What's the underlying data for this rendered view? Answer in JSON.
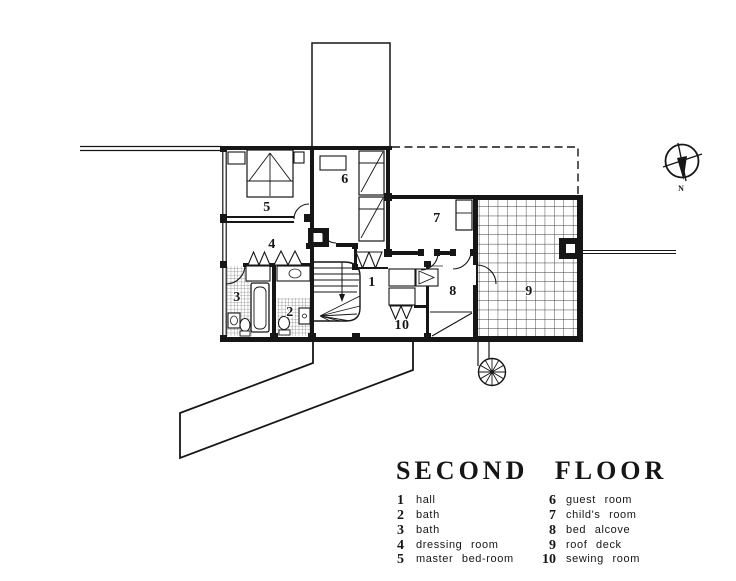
{
  "title": "SECOND FLOOR",
  "rooms": [
    {
      "num": "1",
      "label": "hall"
    },
    {
      "num": "2",
      "label": "bath"
    },
    {
      "num": "3",
      "label": "bath"
    },
    {
      "num": "4",
      "label": "dressing room"
    },
    {
      "num": "5",
      "label": "master bed-room"
    },
    {
      "num": "6",
      "label": "guest room"
    },
    {
      "num": "7",
      "label": "child's room"
    },
    {
      "num": "8",
      "label": "bed alcove"
    },
    {
      "num": "9",
      "label": "roof deck"
    },
    {
      "num": "10",
      "label": "sewing room"
    }
  ],
  "compass": {
    "north_label": "N"
  },
  "colors": {
    "ink": "#161616",
    "paper": "#ffffff"
  }
}
